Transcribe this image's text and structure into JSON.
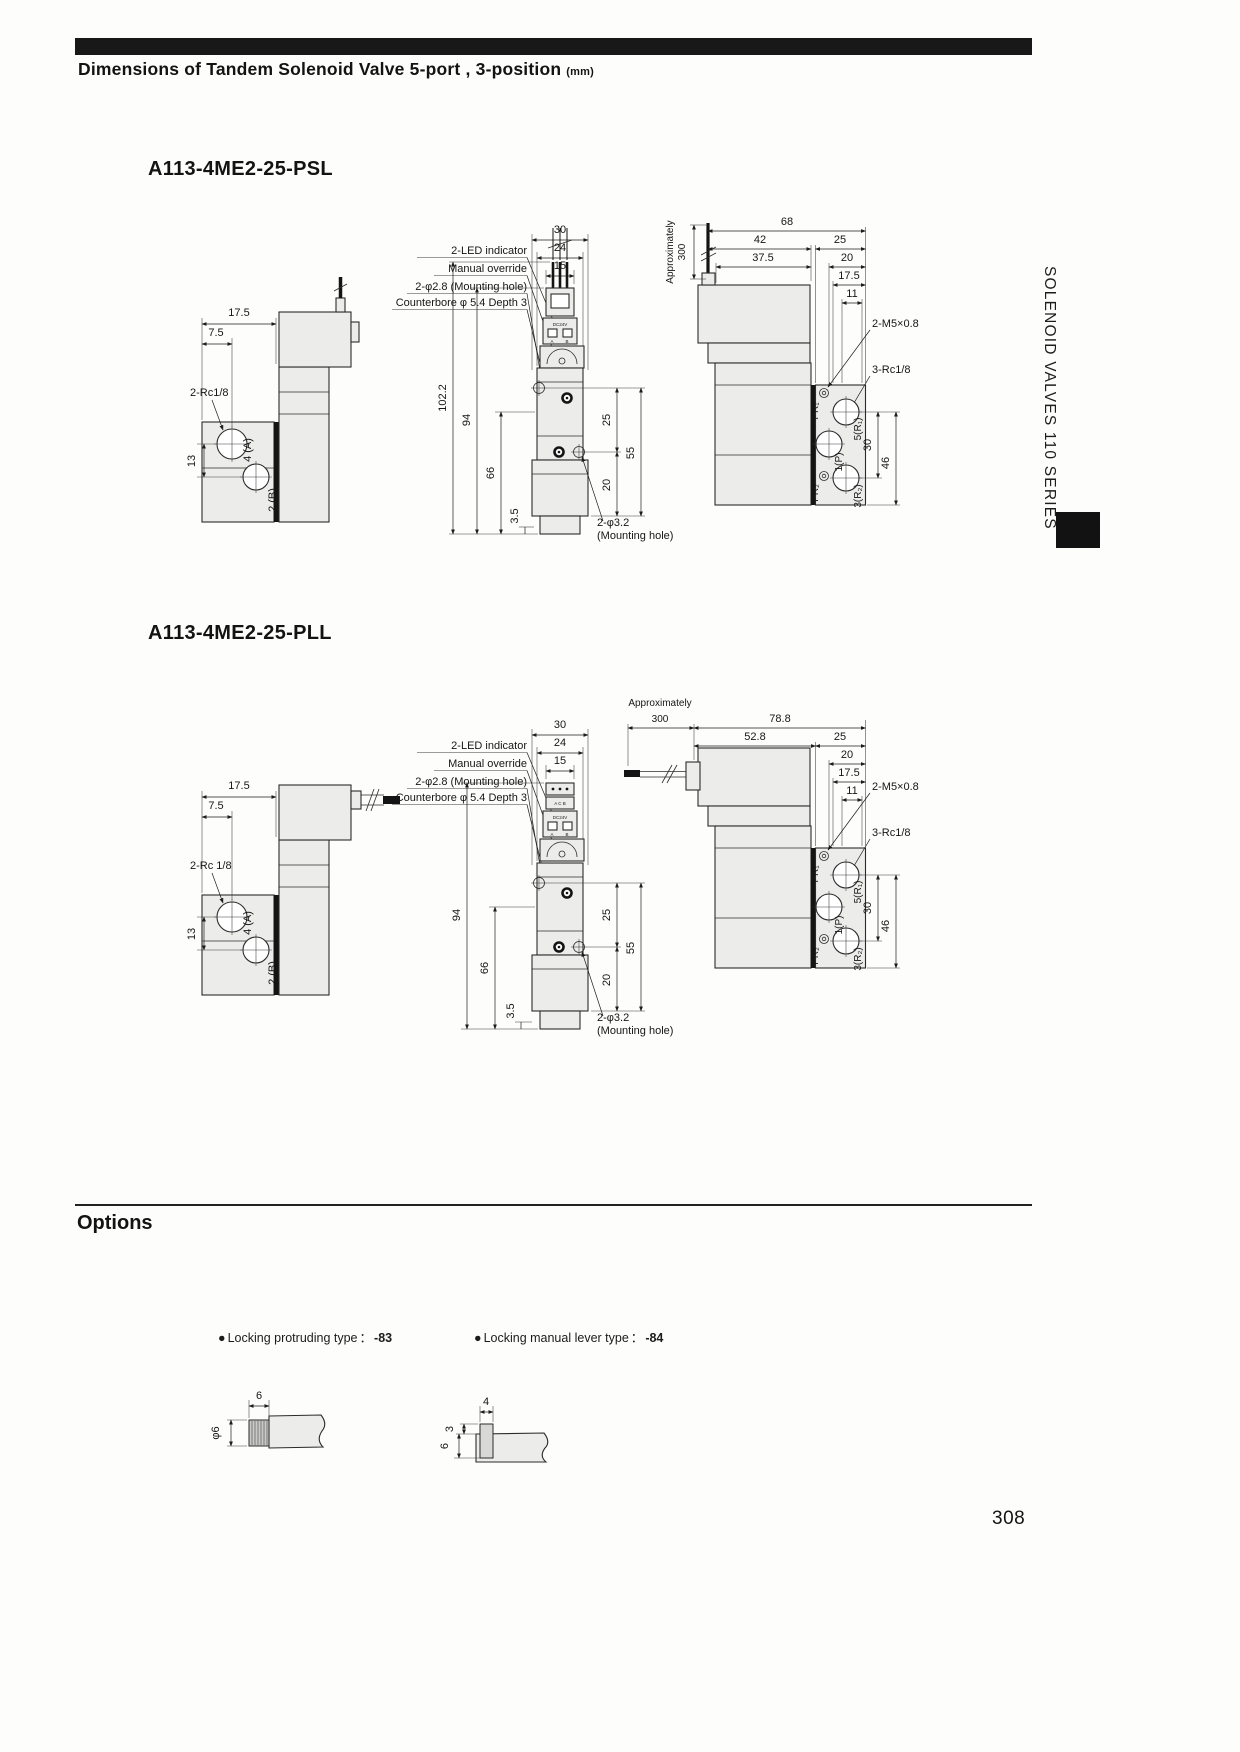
{
  "header": {
    "title": "Dimensions of Tandem Solenoid Valve 5-port , 3-position",
    "unit": "(mm)"
  },
  "side_tab": {
    "series": "SOLENOID VALVES 110 SERIES"
  },
  "psl": {
    "title": "A113-4ME2-25-PSL",
    "left": {
      "depth": "17.5",
      "offset": "7.5",
      "thread": "2-Rc1/8",
      "port_a": "4 (A)",
      "pitch": "13",
      "port_b": "2 (B)"
    },
    "front": {
      "w_outer": "30",
      "w_mid": "24",
      "w_inner": "15",
      "led": "2-LED indicator",
      "override": "Manual override",
      "mount_hole": "2-φ2.8 (Mounting hole)",
      "counterbore": "Counterbore φ 5.4 Depth 3",
      "h_total": "102.2",
      "h_body": "94",
      "h_base": "66",
      "h_foot": "3.5",
      "s_upper": "25",
      "s_full": "55",
      "s_lower": "20",
      "bottom_hole": "2-φ3.2",
      "bottom_hole_note": "(Mounting hole)",
      "volt": "DC24V",
      "t_a": "A",
      "t_b": "B"
    },
    "right": {
      "approx": "Approximately",
      "approx_val": "300",
      "w_total": "68",
      "w_body": "42",
      "w_sol": "37.5",
      "w_port": "25",
      "w_p20": "20",
      "w_p175": "17.5",
      "w_p11": "11",
      "thread_m5": "2-M5×0.8",
      "thread_rc": "3-Rc1/8",
      "pr1": "PR₁",
      "p5r1": "5(R₁)",
      "p1p": "1(P)",
      "pr2": "PR₂",
      "p3r2": "3(R₂)",
      "v30": "30",
      "v46": "46"
    }
  },
  "pll": {
    "title": "A113-4ME2-25-PLL",
    "left": {
      "depth": "17.5",
      "offset": "7.5",
      "thread": "2-Rc 1/8",
      "port_a": "4 (A)",
      "pitch": "13",
      "port_b": "2 (B)"
    },
    "front": {
      "w_outer": "30",
      "w_mid": "24",
      "w_inner": "15",
      "led": "2-LED indicator",
      "override": "Manual override",
      "mount_hole": "2-φ2.8 (Mounting hole)",
      "counterbore": "Counterbore φ 5.4 Depth 3",
      "h_body": "94",
      "h_base": "66",
      "h_foot": "3.5",
      "s_upper": "25",
      "s_full": "55",
      "s_lower": "20",
      "bottom_hole": "2-φ3.2",
      "bottom_hole_note": "(Mounting hole)",
      "volt": "DC24V",
      "t_a": "A",
      "t_b": "B",
      "face": "A C B"
    },
    "right": {
      "approx": "Approximately",
      "approx_val": "300",
      "w_total": "78.8",
      "w_body": "52.8",
      "w_port": "25",
      "w_p20": "20",
      "w_p175": "17.5",
      "w_p11": "11",
      "thread_m5": "2-M5×0.8",
      "thread_rc": "3-Rc1/8",
      "pr1": "PR₁",
      "p5r1": "5(R₁)",
      "p1p": "1(P)",
      "pr2": "PR₂",
      "p3r2": "3(R₂)",
      "v30": "30",
      "v46": "46"
    }
  },
  "options": {
    "heading": "Options",
    "items": [
      {
        "bullet": "●",
        "label": "Locking protruding type",
        "sep": "：",
        "code": "-83"
      },
      {
        "bullet": "●",
        "label": "Locking manual lever type",
        "sep": "：",
        "code": "-84"
      }
    ],
    "protruding": {
      "width": "6",
      "dia": "φ6"
    },
    "lever": {
      "width": "4",
      "h_top": "3",
      "h_bottom": "6"
    }
  },
  "footer": {
    "page_number": "308"
  }
}
